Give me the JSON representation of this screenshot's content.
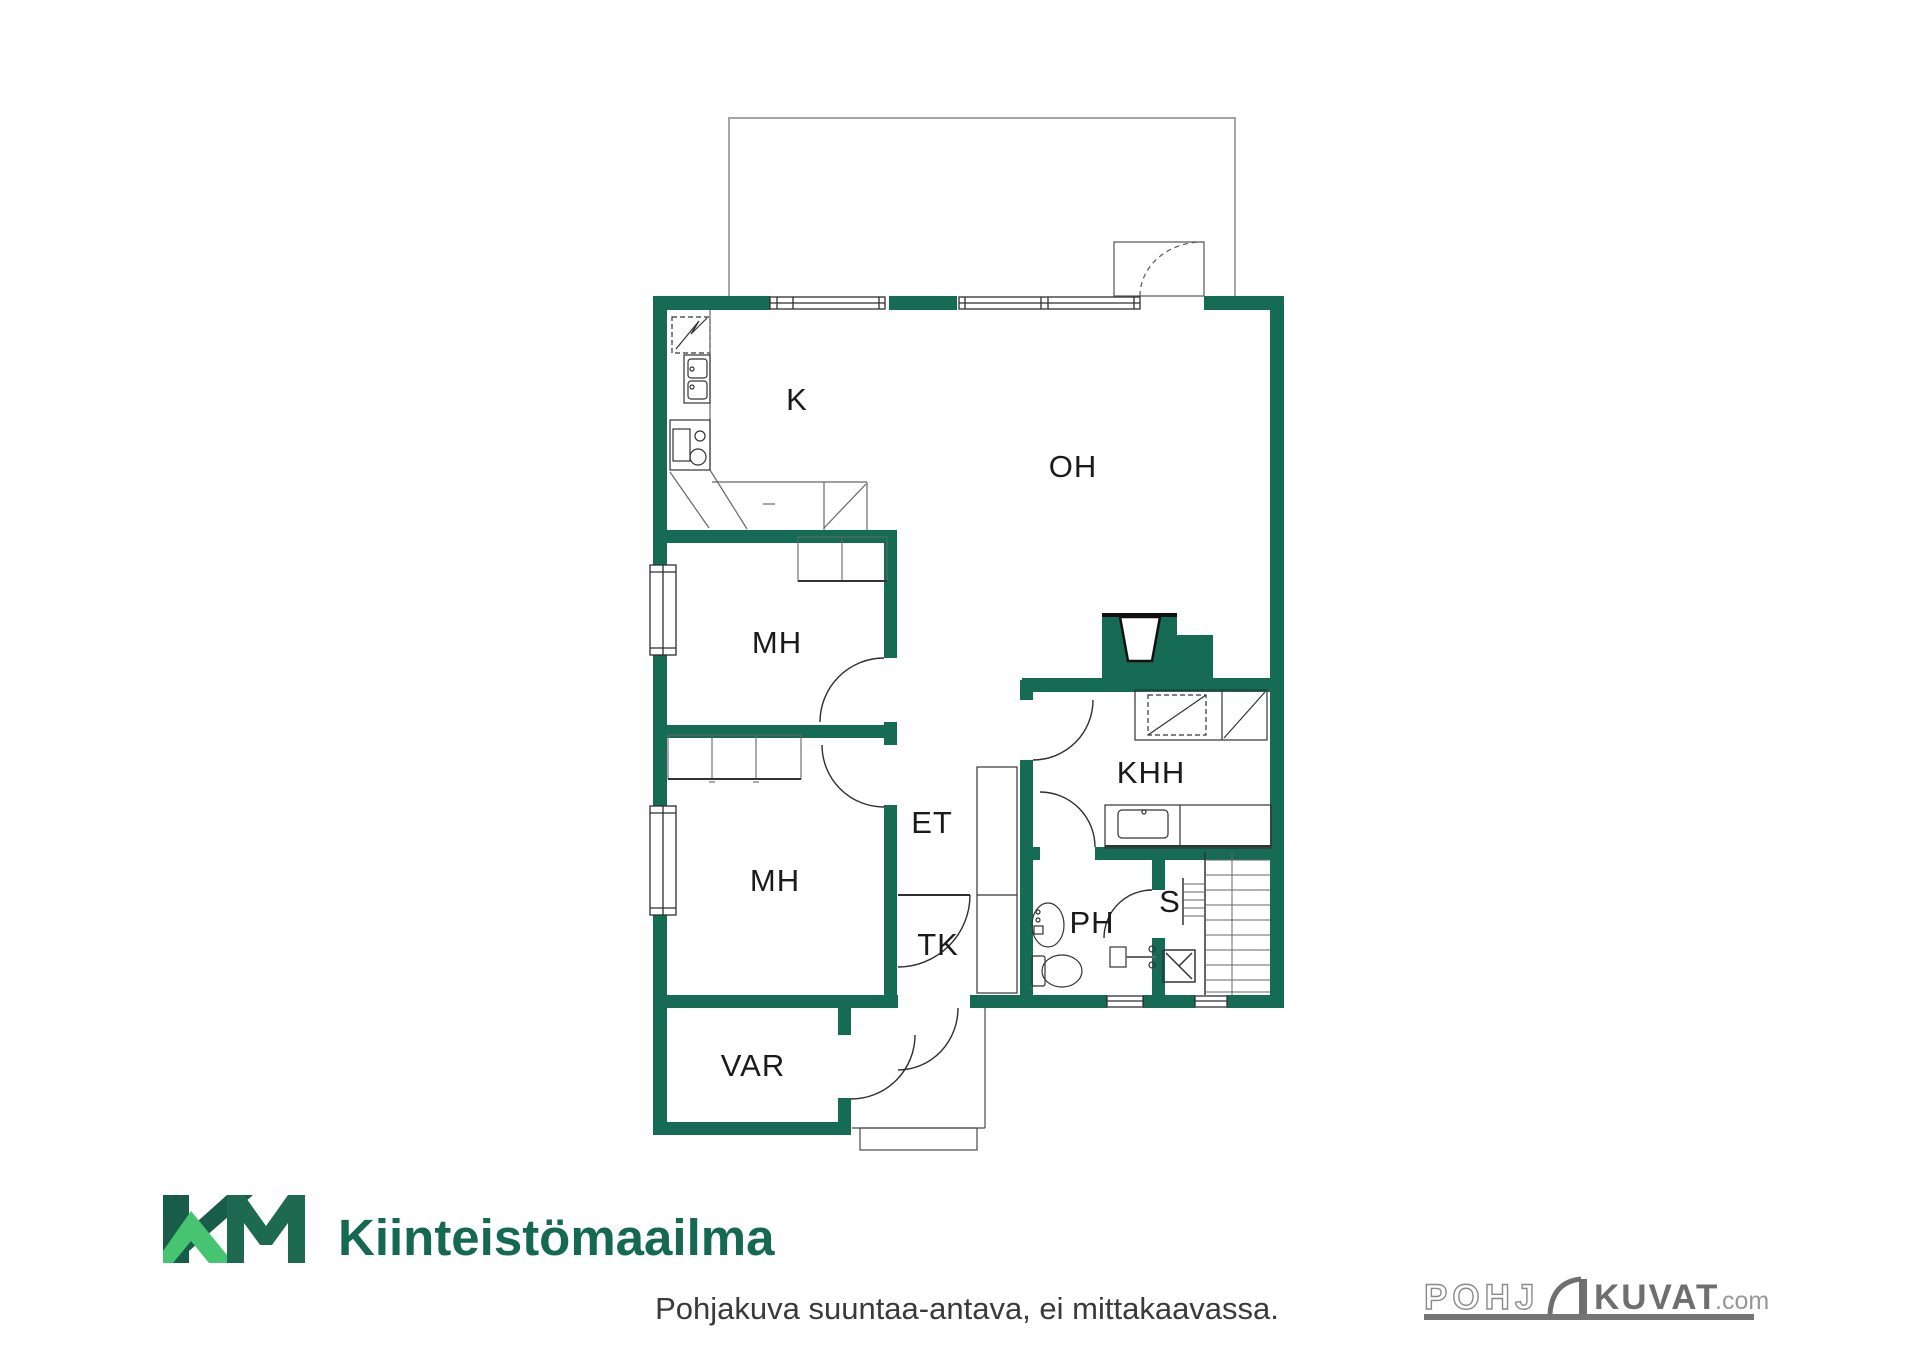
{
  "floorplan": {
    "rooms": [
      {
        "label": "K",
        "name": "kitchen"
      },
      {
        "label": "OH",
        "name": "living-room"
      },
      {
        "label": "MH",
        "name": "bedroom-1"
      },
      {
        "label": "MH",
        "name": "bedroom-2"
      },
      {
        "label": "ET",
        "name": "entry-hall"
      },
      {
        "label": "KHH",
        "name": "utility-room"
      },
      {
        "label": "TK",
        "name": "draft-lobby"
      },
      {
        "label": "PH",
        "name": "washroom"
      },
      {
        "label": "S",
        "name": "sauna"
      },
      {
        "label": "VAR",
        "name": "storage"
      }
    ],
    "wall_color": "#156B53"
  },
  "branding": {
    "company": "Kiinteistömaailma",
    "monogram": "KM",
    "dark_green": "#1B654E",
    "light_green": "#46C472"
  },
  "footer": {
    "disclaimer": "Pohjakuva suuntaa-antava, ei mittakaavassa."
  },
  "watermark": {
    "part1": "POHJ",
    "part2": "KUVAT",
    "suffix": ".com",
    "color": "#757575"
  }
}
